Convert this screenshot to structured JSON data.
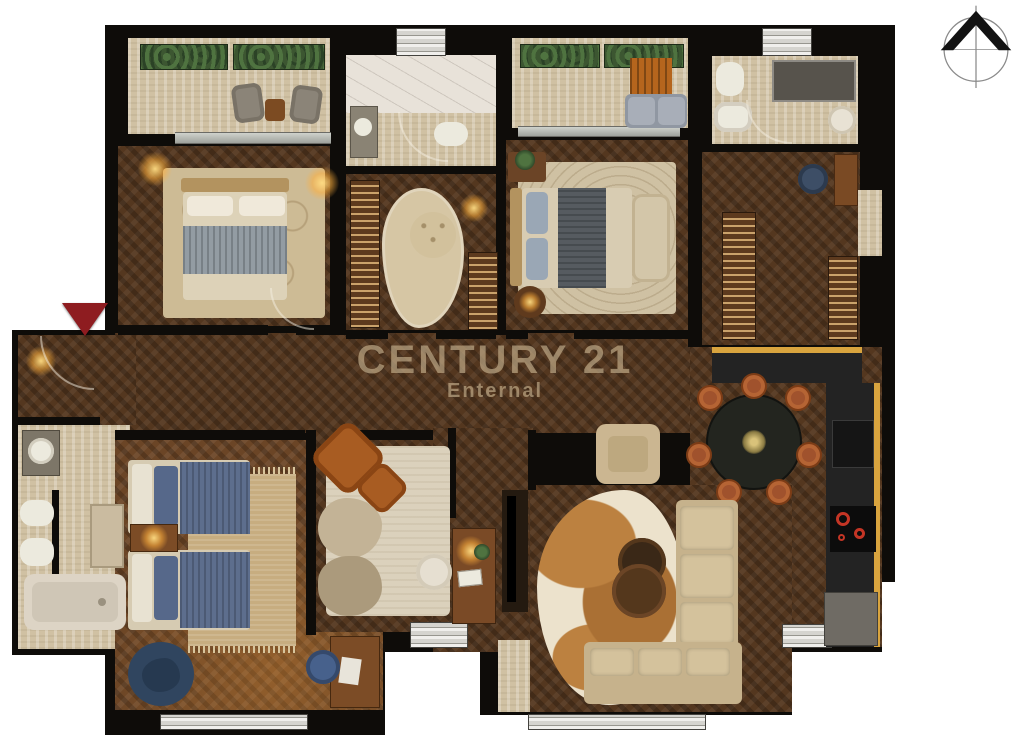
{
  "watermark": {
    "line1": "CENTURY 21",
    "line2": "Enternal"
  },
  "icons": {
    "compass": "north-compass-icon",
    "entrance": "entrance-arrow-icon"
  },
  "palette": {
    "wall": "#0e0c09",
    "wood_dark": "#54371f",
    "wood_mid": "#6b4526",
    "travertine": "#d0c1a3",
    "marble": "#e8e2d9",
    "accent_gold": "#d9a43e",
    "watermark": "#cdb894",
    "entrance_red": "#8e1c20",
    "sofa_beige": "#c6b28c",
    "denim_blue": "#56688a",
    "leather_orange": "#a85c22",
    "plant_green": "#3c5631"
  }
}
